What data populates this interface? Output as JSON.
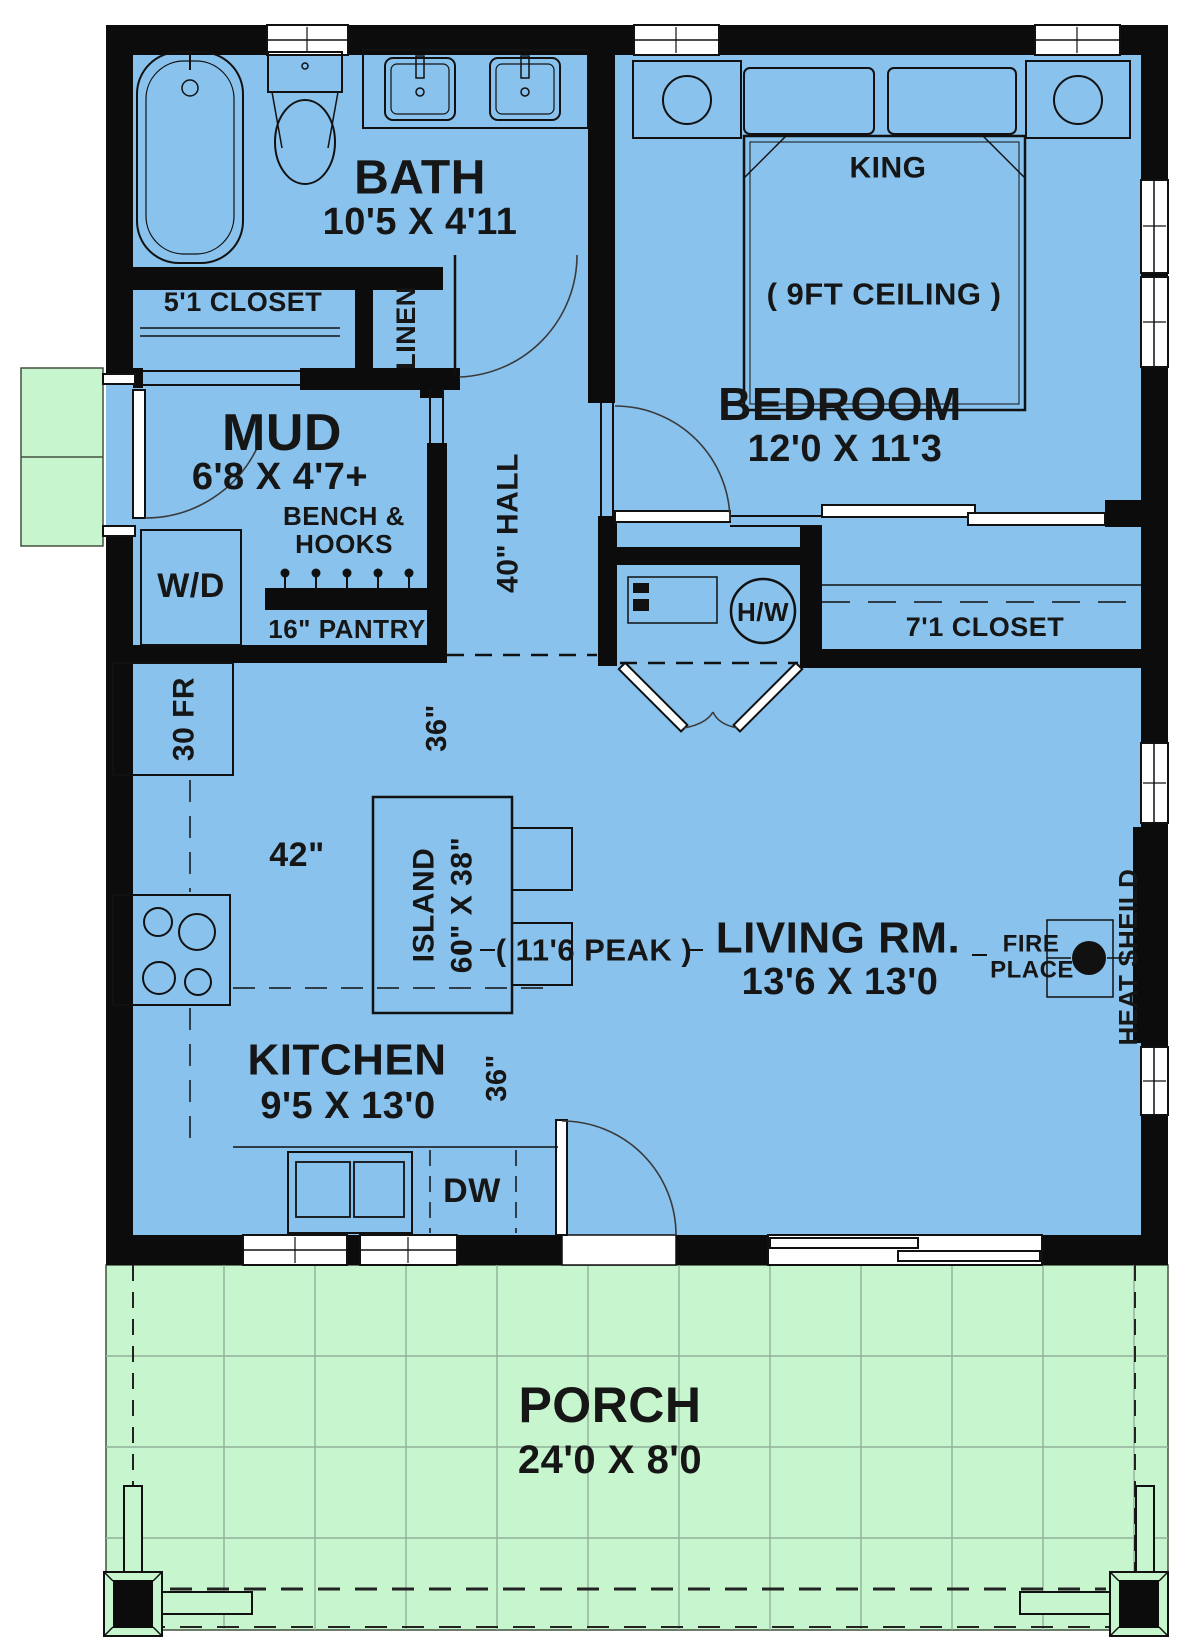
{
  "title": "One-bedroom cottage floor plan",
  "colors": {
    "floor": "#89c2ec",
    "porch": "#c7f5cd",
    "wall": "#0c0c0c"
  },
  "rooms": {
    "bath": {
      "name": "BATH",
      "dims": "10'5 X 4'11"
    },
    "closet_5_1": {
      "name": "5'1 CLOSET"
    },
    "linen": {
      "name": "LINEN"
    },
    "mud": {
      "name": "MUD",
      "dims": "6'8 X 4'7+"
    },
    "hall": {
      "name": "40\" HALL"
    },
    "bedroom": {
      "name": "BEDROOM",
      "dims": "12'0 X 11'3",
      "bed": "KING",
      "ceiling": "( 9FT CEILING )"
    },
    "closet_7_1": {
      "name": "7'1 CLOSET"
    },
    "kitchen": {
      "name": "KITCHEN",
      "dims": "9'5 X 13'0"
    },
    "living": {
      "name": "LIVING RM.",
      "dims": "13'6 X 13'0"
    },
    "porch": {
      "name": "PORCH",
      "dims": "24'0 X 8'0"
    }
  },
  "features": {
    "bench_hooks_line1": "BENCH &",
    "bench_hooks_line2": "HOOKS",
    "washer_dryer": "W/D",
    "pantry": "16\" PANTRY",
    "water_heater": "H/W",
    "fridge": "30 FR",
    "island_line1": "ISLAND",
    "island_line2": "60\" X 38\"",
    "dishwasher": "DW",
    "fireplace_line1": "FIRE",
    "fireplace_line2": "PLACE",
    "heat_shield": "HEAT SHEILD",
    "peak": "( 11'6 PEAK )"
  },
  "dimensions": {
    "counter_42": "42\"",
    "island_clearance_36": "36\"",
    "kitchen_clearance_36": "36\""
  }
}
